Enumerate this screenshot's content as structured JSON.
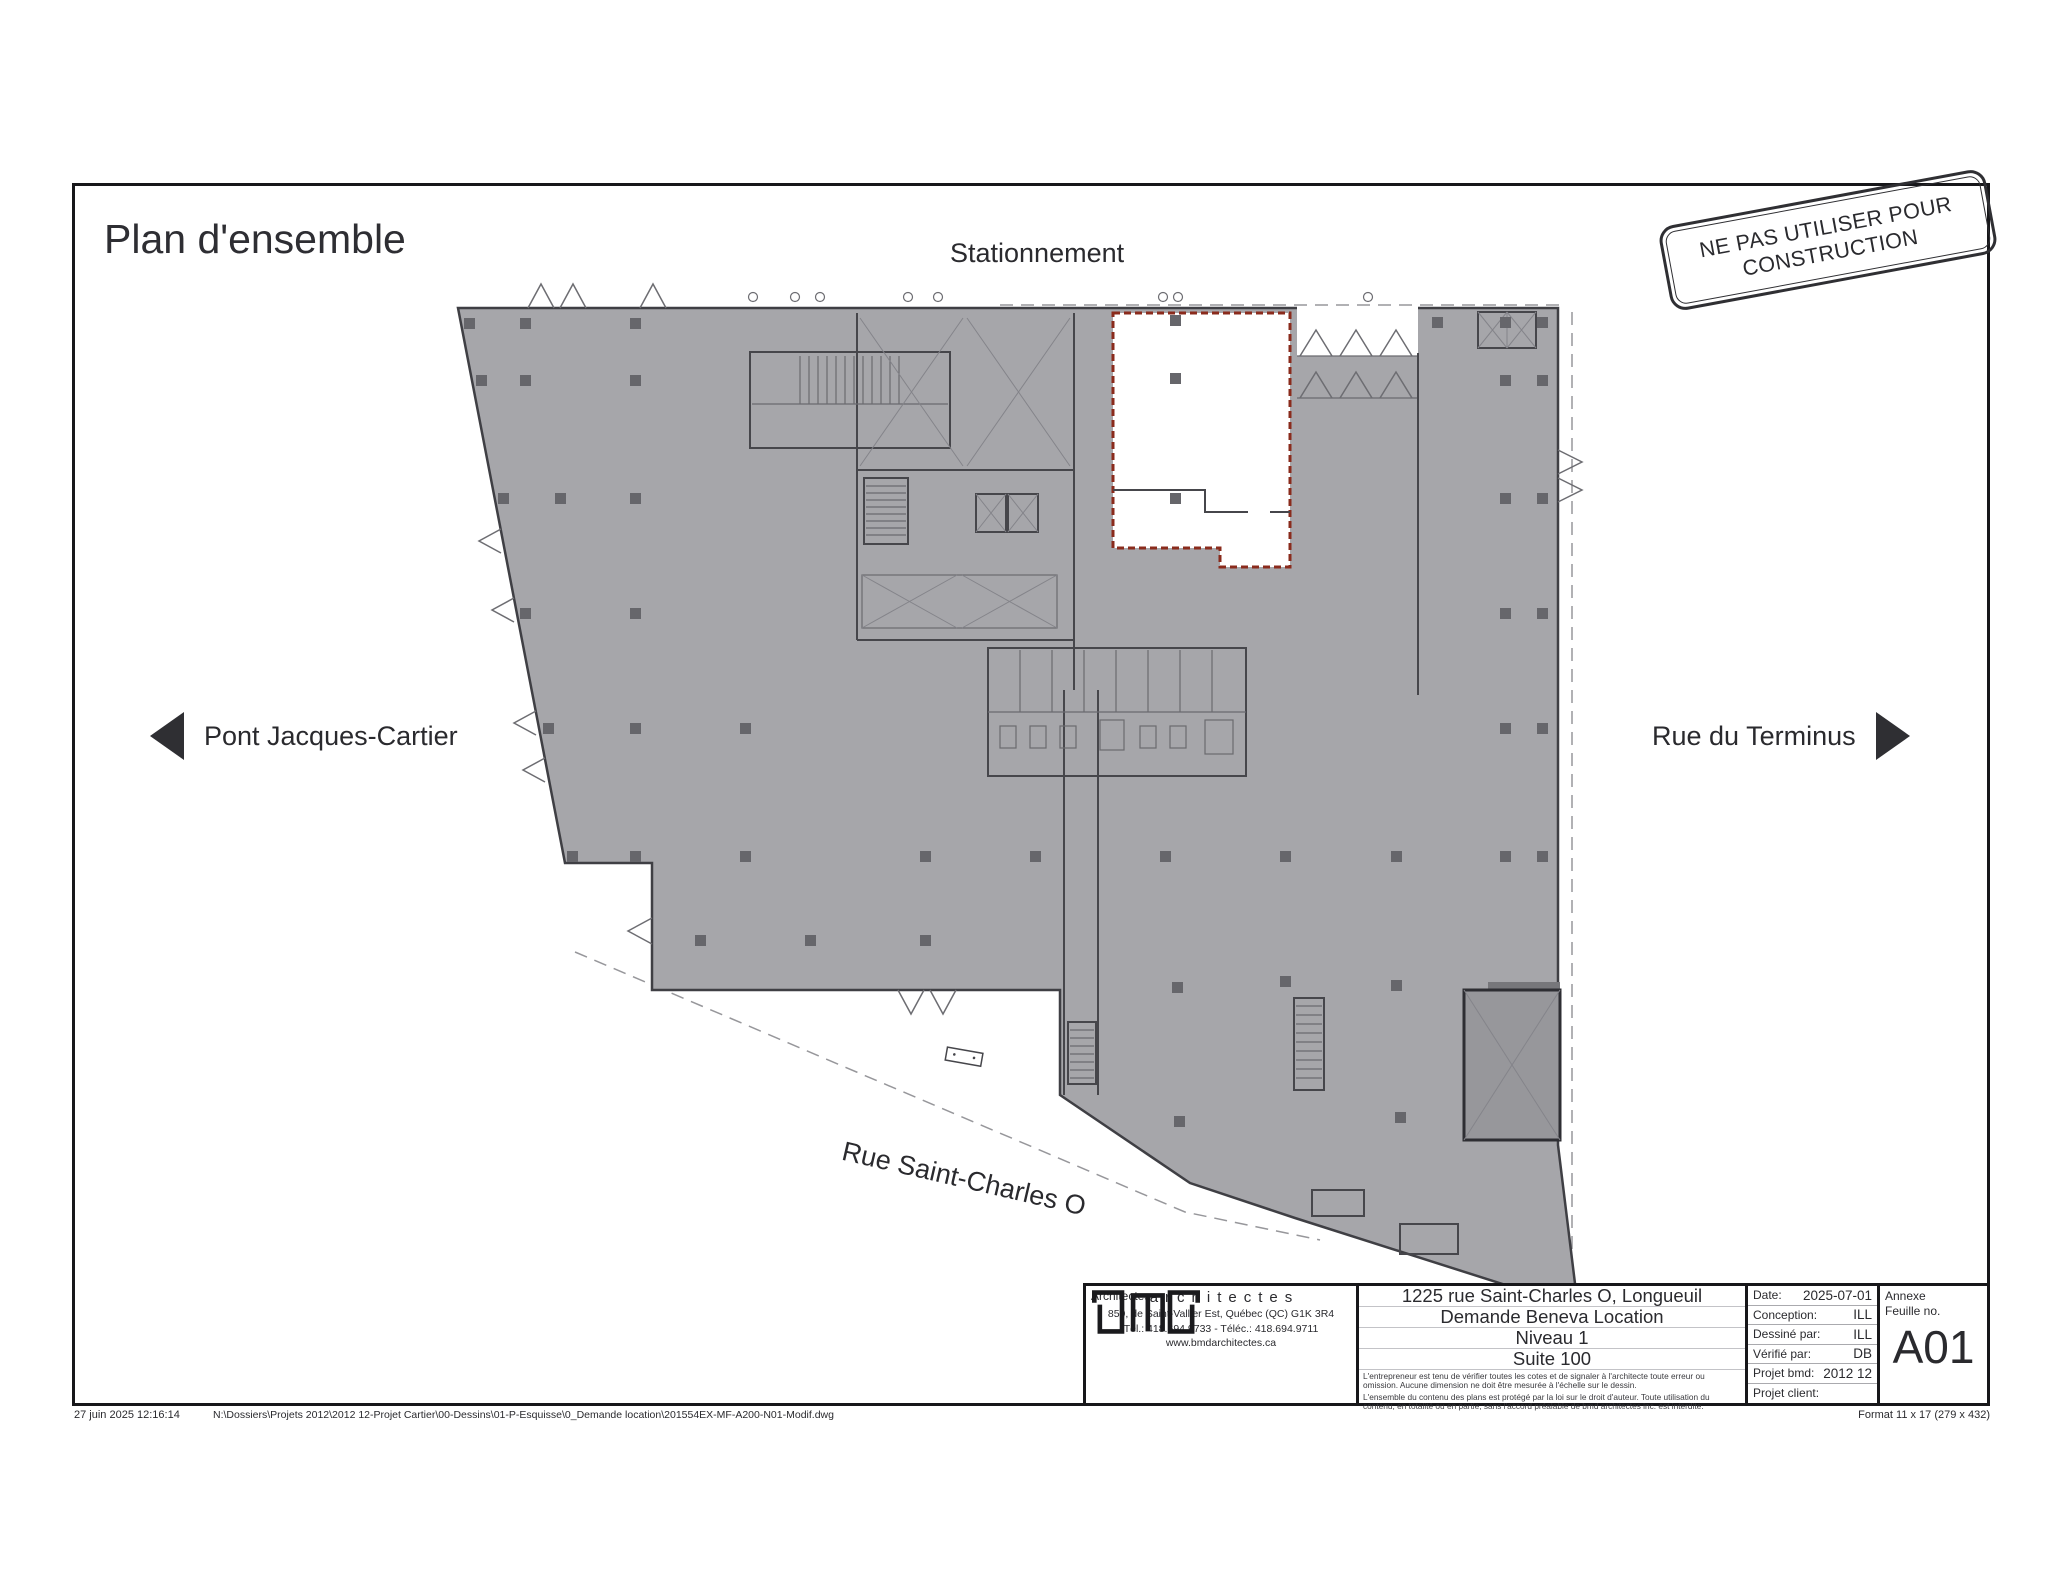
{
  "page": {
    "title": "Plan d'ensemble",
    "stamp_line1": "NE PAS UTILISER POUR",
    "stamp_line2": "CONSTRUCTION"
  },
  "plan_labels": {
    "top": "Stationnement",
    "left": "Pont Jacques-Cartier",
    "right": "Rue du Terminus",
    "bottom": "Rue Saint-Charles O"
  },
  "title_block": {
    "architects_label": "Architectes",
    "logo_word": "architectes",
    "address": "850, de Saint-Vallier Est, Québec (QC) G1K 3R4",
    "phone": "Tél.: 418.694.9733 - Téléc.: 418.694.9711",
    "website": "www.bmdarchitectes.ca",
    "project": {
      "line1": "1225 rue Saint-Charles O, Longueuil",
      "line2": "Demande Beneva Location",
      "line3": "Niveau 1",
      "line4": "Suite 100"
    },
    "disclaimer1": "L'entrepreneur est tenu de vérifier toutes les cotes et de signaler à l'architecte toute erreur ou omission. Aucune dimension ne doit être mesurée à l'échelle sur le dessin.",
    "disclaimer2": "L'ensemble du contenu des plans est protégé par la loi sur le droit d'auteur. Toute utilisation du contenu, en totalité ou en partie, sans l'accord préalable de bmd architectes inc. est interdite.",
    "fields": [
      {
        "label": "Date:",
        "value": "2025-07-01"
      },
      {
        "label": "Conception:",
        "value": "ILL"
      },
      {
        "label": "Dessiné par:",
        "value": "ILL"
      },
      {
        "label": "Vérifié par:",
        "value": "DB"
      },
      {
        "label": "Projet bmd:",
        "value": "2012 12"
      },
      {
        "label": "Projet client:",
        "value": ""
      }
    ],
    "annexe_label": "Annexe",
    "sheet_label": "Feuille no.",
    "sheet_number": "A01"
  },
  "footer": {
    "datetime": "27 juin 2025 12:16:14",
    "filepath": "N:\\Dossiers\\Projets 2012\\2012 12-Projet Cartier\\00-Dessins\\01-P-Esquisse\\0_Demande location\\201554EX-MF-A200-N01-Modif.dwg",
    "format": "Format 11 x 17 (279 x 432)"
  },
  "colors": {
    "plan_fill": "#a6a6aa",
    "wall": "#3f3f44",
    "suite_outline": "#8a2b1c",
    "ink": "#2a2a2e"
  }
}
